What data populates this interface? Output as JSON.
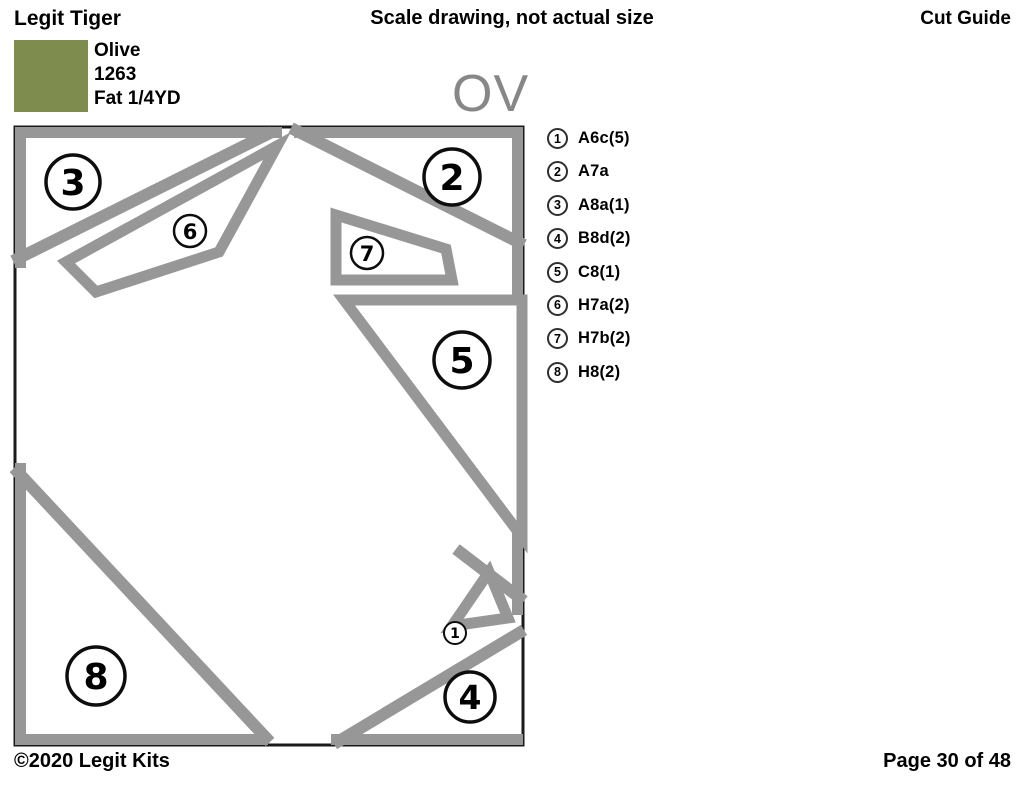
{
  "header": {
    "title": "Legit Tiger",
    "center_note": "Scale drawing, not actual size",
    "right_label": "Cut Guide"
  },
  "fabric": {
    "name": "Olive",
    "code": "1263",
    "cut": "Fat 1/4YD",
    "swatch_color": "#7e8d4d"
  },
  "section_label": "OV",
  "legend": {
    "items": [
      {
        "number": "1",
        "label": "A6c(5)"
      },
      {
        "number": "2",
        "label": "A7a"
      },
      {
        "number": "3",
        "label": "A8a(1)"
      },
      {
        "number": "4",
        "label": "B8d(2)"
      },
      {
        "number": "5",
        "label": "C8(1)"
      },
      {
        "number": "6",
        "label": "H7a(2)"
      },
      {
        "number": "7",
        "label": "H7b(2)"
      },
      {
        "number": "8",
        "label": "H8(2)"
      }
    ]
  },
  "diagram": {
    "markers": {
      "piece1": "1",
      "piece2": "2",
      "piece3": "3",
      "piece4": "4",
      "piece5": "5",
      "piece6": "6",
      "piece7": "7",
      "piece8": "8"
    }
  },
  "footer": {
    "copyright": "©2020 Legit Kits",
    "page": "Page 30 of 48"
  },
  "colors": {
    "band_gray": "#979797",
    "outline_black": "#1a1a1a",
    "ov_label_gray": "#878787",
    "circle_outline": "#0d0d0d"
  }
}
